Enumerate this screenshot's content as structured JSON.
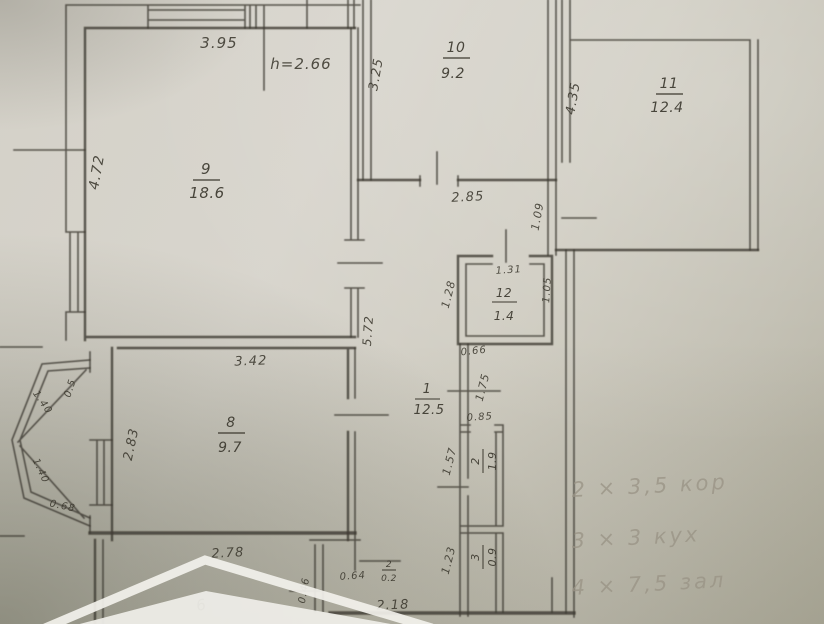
{
  "plan": {
    "rooms": [
      {
        "number": "9",
        "area": "18.6"
      },
      {
        "number": "10",
        "area": "9.2"
      },
      {
        "number": "11",
        "area": "12.4"
      },
      {
        "number": "12",
        "area": "1.4"
      },
      {
        "number": "1",
        "area": "12.5"
      },
      {
        "number": "8",
        "area": "9.7"
      },
      {
        "number": "2",
        "area": "1.9"
      },
      {
        "number": "3",
        "area": "0.9"
      },
      {
        "number": "2",
        "area": "0.2"
      }
    ],
    "ceiling_height_note": "h=2.66",
    "dimensions": {
      "top_width": "3.95",
      "left_height": "4.72",
      "kitchen_left": "3.25",
      "hall_top": "2.85",
      "hall_right_small": "1.09",
      "room11_left": "4.35",
      "hall_left": "5.72",
      "wc_top": "1.31",
      "wc_right": "1.05",
      "wc_left": "1.28",
      "below_wc": "0.66",
      "passage": "1.75",
      "door_small": "0.85",
      "bath_left": "1.57",
      "toilet_left": "1.23",
      "room8_top": "3.42",
      "room8_left": "2.83",
      "room8_bottom": "2.78",
      "closet_width": "0.64",
      "closet_left": "0.46",
      "bottom_width": "2.18",
      "bay_top": "0.5",
      "bay_upper": "1.40",
      "bay_lower": "1.40",
      "bay_bottom": "0.68"
    },
    "pencil_notes": [
      "2 × 3,5 кор",
      "3 × 3 кух",
      "4 × 7,5 зал"
    ],
    "watermark_glyph": "6"
  },
  "colors": {
    "ink": "#3e3b32",
    "pencil": "#9a9486",
    "paper": "#d2cfc6"
  }
}
